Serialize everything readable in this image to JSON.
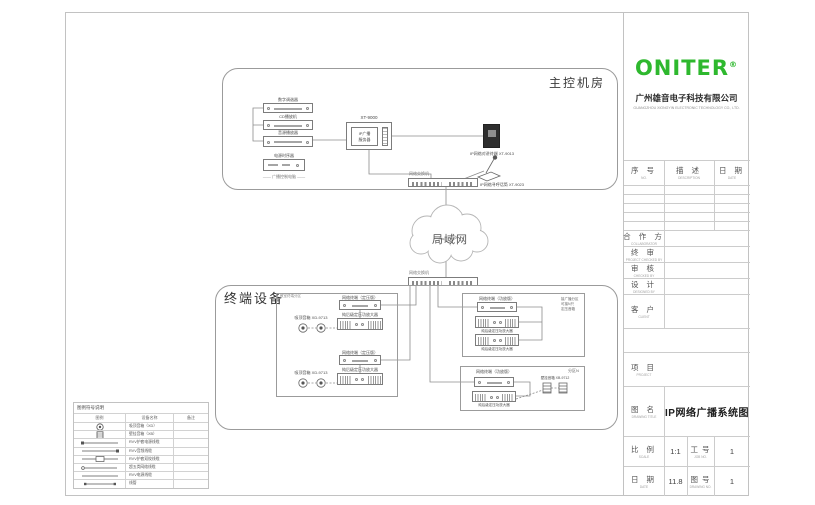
{
  "titleblock": {
    "brand": "ONITER",
    "reg": "®",
    "company_cn": "广州雄音电子科技有限公司",
    "company_en": "GUANGZHOU XIONGYIN ELECTRONIC TECHNOLOGY CO., LTD.",
    "rev_no_cn": "序  号",
    "rev_no_en": "NO.",
    "rev_desc_cn": "描  述",
    "rev_desc_en": "DESCRIPTION",
    "rev_date_cn": "日  期",
    "rev_date_en": "DATE",
    "signoff": [
      {
        "cn": "合 作 方",
        "en": "COLLABORATOR"
      },
      {
        "cn": "终  审",
        "en": "PROJECT CHECKED BY"
      },
      {
        "cn": "审  核",
        "en": "CHECKED BY"
      },
      {
        "cn": "设  计",
        "en": "DESIGNED BY"
      },
      {
        "cn": "客  户",
        "en": "CLIENT"
      }
    ],
    "project_cn": "项  目",
    "project_en": "PROJECT",
    "dwg_cn": "图  名",
    "dwg_en": "DRAWING TITLE",
    "dwg_value": "IP网络广播系统图",
    "scale_cn": "比  例",
    "scale_en": "SCALE",
    "scale_value": "1:1",
    "job_cn": "工  号",
    "job_en": "JOB NO.",
    "job_value": "1",
    "date_cn": "日  期",
    "date_en": "DATE",
    "date_value": "11.8",
    "no_cn": "图  号",
    "no_en": "DRAWING NO.",
    "no_value": "1"
  },
  "control_room": {
    "label": "主控机房",
    "source1": "数字调谐器",
    "source2": "CD播放机",
    "source3": "音源播放器",
    "server_model": "XT-9000",
    "server_text": "IP广播\n服务器",
    "sequencer": "电源时序器",
    "sequencer_note": "—— 广播控制电脑 ——",
    "intercom": "IP网络对讲终端 XT-9013",
    "mic": "IP网络寻呼话筒 XT-9023",
    "switch": "网络交换机"
  },
  "lan": "局域网",
  "switch2": "网络交换机",
  "terminal_area": {
    "label": "终端设备",
    "box1_label": "教室终端分区",
    "g1_terminal": "网络终端（定压版）",
    "g1_amp": "纯后级定压功放大器",
    "g1_speaker": "吸顶音箱 XD-9713",
    "g2_terminal": "网络终端（定压版）",
    "g2_amp": "纯后级定压功放大器",
    "g2_speaker": "吸顶音箱 XD-9713",
    "box2_terminal": "网络终端（功放版）",
    "box2_amp1": "纯后级定压功放大器",
    "box2_amp2": "纯后级定压功放大器",
    "box2_note": "接广播分区\n可接N只\n定压音箱",
    "box3_terminal": "网络终端（功放版）",
    "box3_amp": "纯后级定压功放大器",
    "box3_speaker": "壁挂音箱 XB-9712",
    "box3_note": "分区N"
  },
  "legend": {
    "title": "图例符号说明",
    "h_icon": "图例",
    "h_name": "设备名称",
    "h_remark": "备注",
    "rows": [
      {
        "name": "吸顶音箱（XD）"
      },
      {
        "name": "壁挂音箱（XB）"
      },
      {
        "name": "RVV护套电源线缆"
      },
      {
        "name": "RVV音频线缆"
      },
      {
        "name": "RVV护套双绞线缆"
      },
      {
        "name": "超五类网络线缆"
      },
      {
        "name": "RVV电源线缆"
      },
      {
        "name": "线管"
      }
    ]
  },
  "colors": {
    "brand_green": "#2eb82e",
    "wire_gray": "#8c8c8c"
  }
}
